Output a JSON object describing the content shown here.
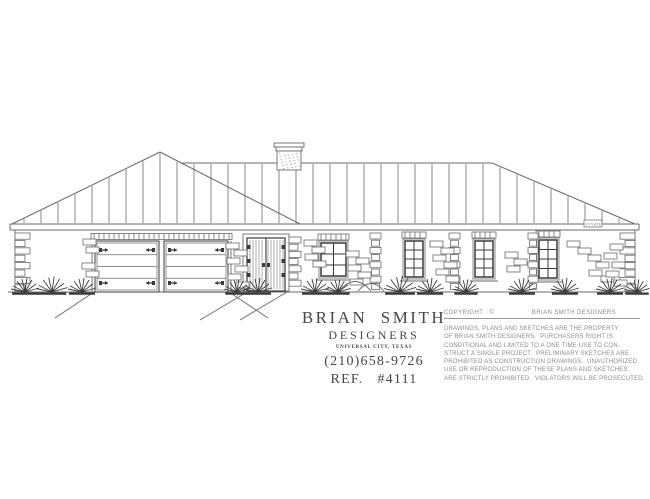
{
  "page": {
    "background": "#ffffff",
    "line_color": "#6a6a6a",
    "dark_line_color": "#3a3a3a",
    "title_text_color": "#474747",
    "fine_print_color": "#8d8d8d"
  },
  "drawing": {
    "plate_label": "8' PLATE"
  },
  "title_block": {
    "firm_name_line1": "BRIAN  SMITH",
    "firm_name_line2": "DESIGNERS",
    "location": "UNIVERSAL CITY, TEXAS",
    "phone": "(210)658-9726",
    "reference": "REF.   #4111"
  },
  "copyright_block": {
    "label": "COPYRIGHT : ©",
    "owner": "BRIAN SMITH DESIGNERS",
    "lines": [
      "DRAWINGS, PLANS AND SKETCHES ARE THE PROPERTY",
      "OF BRIAN SMITH DESIGNERS.  PURCHASERS RIGHT IS",
      "CONDITIONAL AND LIMITED TO A ONE TIME USE TO CON-",
      "STRUCT A SINGLE PROJECT.  PRELIMINARY SKETCHES ARE",
      "PROHIBITED AS CONSTRUCTION DRAWINGS.  UNAUTHORIZED",
      "USE OR REPRODUCTION OF THESE PLANS AND SKETCHES",
      "ARE STRICTLY PROHIBITED.  VIOLATORS WILL BE PROSECUTED."
    ]
  }
}
